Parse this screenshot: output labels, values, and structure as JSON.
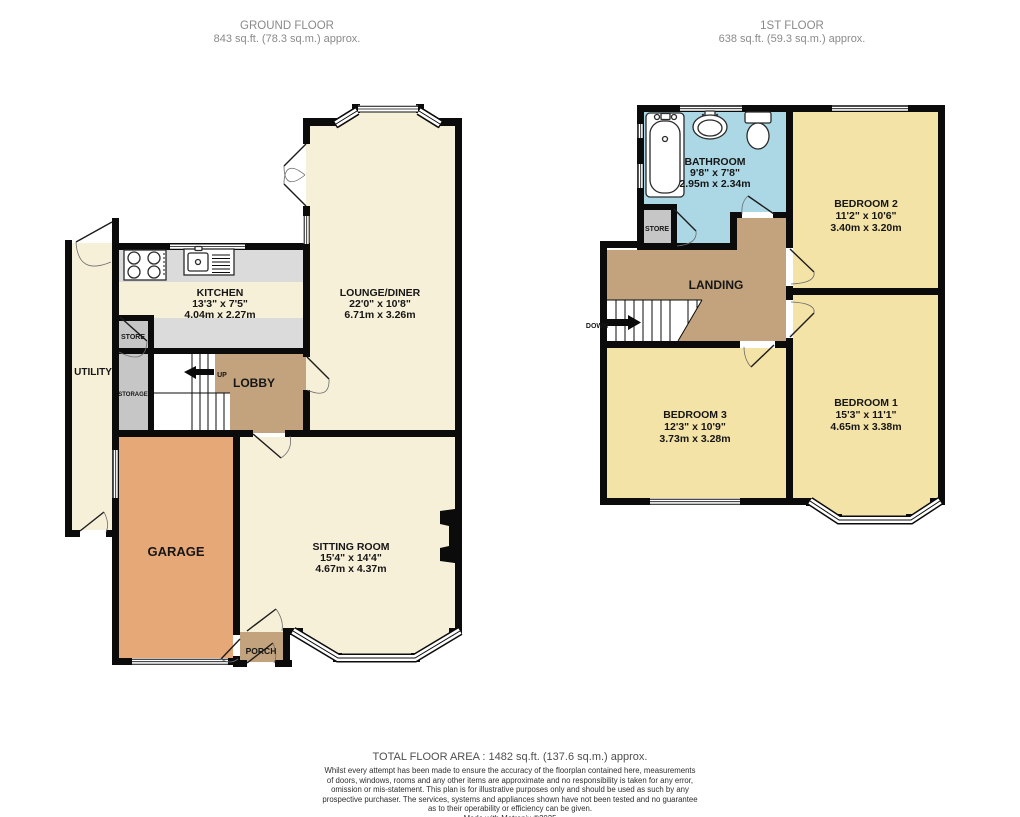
{
  "floors": {
    "ground": {
      "title": "GROUND FLOOR",
      "area": "843 sq.ft. (78.3 sq.m.) approx.",
      "rooms": {
        "kitchen": {
          "name": "KITCHEN",
          "imperial": "13'3\"  x 7'5\"",
          "metric": "4.04m  x 2.27m"
        },
        "lounge": {
          "name": "LOUNGE/DINER",
          "imperial": "22'0\"  x 10'8\"",
          "metric": "6.71m  x 3.26m"
        },
        "sitting": {
          "name": "SITTING ROOM",
          "imperial": "15'4\"  x 14'4\"",
          "metric": "4.67m  x 4.37m"
        },
        "garage": {
          "name": "GARAGE"
        },
        "utility": {
          "name": "UTILITY"
        },
        "lobby": {
          "name": "LOBBY"
        },
        "porch": {
          "name": "PORCH"
        },
        "store": {
          "name": "STORE"
        },
        "storage": {
          "name": "STORAGE"
        },
        "up_label": "UP"
      }
    },
    "first": {
      "title": "1ST FLOOR",
      "area": "638 sq.ft. (59.3 sq.m.) approx.",
      "rooms": {
        "bathroom": {
          "name": "BATHROOM",
          "imperial": "9'8\"  x 7'8\"",
          "metric": "2.95m  x 2.34m"
        },
        "bedroom1": {
          "name": "BEDROOM 1",
          "imperial": "15'3\"  x 11'1\"",
          "metric": "4.65m  x 3.38m"
        },
        "bedroom2": {
          "name": "BEDROOM 2",
          "imperial": "11'2\"  x 10'6\"",
          "metric": "3.40m  x 3.20m"
        },
        "bedroom3": {
          "name": "BEDROOM 3",
          "imperial": "12'3\"  x 10'9\"",
          "metric": "3.73m  x 3.28m"
        },
        "landing": {
          "name": "LANDING"
        },
        "store": {
          "name": "STORE"
        },
        "down_label": "DOWN"
      }
    }
  },
  "footer": {
    "total": "TOTAL FLOOR AREA : 1482 sq.ft. (137.6 sq.m.) approx.",
    "disclaimer_line1": "Whilst every attempt has been made to ensure the accuracy of the floorplan contained here, measurements",
    "disclaimer_line2": "of doors, windows, rooms and any other items are approximate and no responsibility is taken for any error,",
    "disclaimer_line3": "omission or mis-statement. This plan is for illustrative purposes only and should be used as such by any",
    "disclaimer_line4": "prospective purchaser. The services, systems and appliances shown have not been tested and no guarantee",
    "disclaimer_line5": "as to their operability or efficiency can be given.",
    "credit": "Made with Metropix ©2025"
  },
  "colors": {
    "room_cream": "#F7F0D8",
    "bedroom_yellow": "#F4E3A6",
    "hall_tan": "#C2A37D",
    "garage_orange": "#E7A877",
    "bathroom_blue": "#ACD8E5",
    "counter_gray": "#DBDBDB",
    "store_gray": "#C6C6C6",
    "wall_black": "#0B0B0B",
    "header_gray": "#8A8A8A"
  }
}
